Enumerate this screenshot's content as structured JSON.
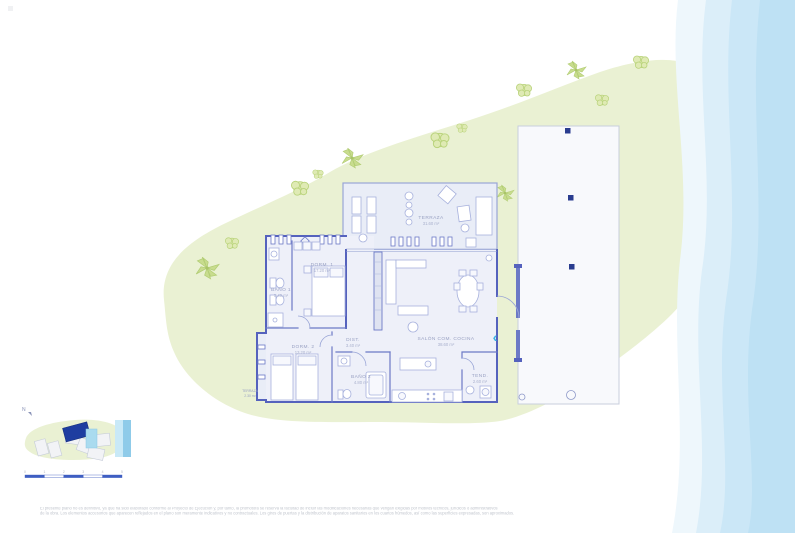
{
  "plan": {
    "rooms": [
      {
        "id": "terraza",
        "label": "TERRAZA",
        "area": "31.60 m²"
      },
      {
        "id": "dorm1",
        "label": "DORM. 1",
        "area": "17.20 m²"
      },
      {
        "id": "bano1",
        "label": "BAÑO 1",
        "area": "5.40 m²"
      },
      {
        "id": "dorm2",
        "label": "DORM. 2",
        "area": "13.20 m²"
      },
      {
        "id": "dist",
        "label": "DIST.",
        "area": "3.40 m²"
      },
      {
        "id": "bano2",
        "label": "BAÑO 2",
        "area": "4.80 m²"
      },
      {
        "id": "salon",
        "label": "SALÓN COM. COCINA",
        "area": "38.60 m²"
      },
      {
        "id": "tend",
        "label": "TEND.",
        "area": "2.60 m²"
      },
      {
        "id": "terraza2",
        "label": "TERRAZA",
        "area": "2.30 m²"
      }
    ],
    "nav_chevron": "‹"
  },
  "minimap": {
    "compass": "N"
  },
  "scalebar": {
    "ticks": [
      "0",
      "1",
      "2",
      "3",
      "4",
      "5"
    ],
    "unit": "m"
  },
  "disclaimer": {
    "line1": "El presente plano no es definitivo, ya que ha sido elaborado conforme al Proyecto de Ejecución y, por tanto, la promotora se reserva la facultad de incluir las modificaciones necesarias que vengan exigidas por motivos técnicos, jurídicos o administrativos",
    "line2": "de la obra. Los elementos accesorios que aparecen reflejados en el plano son meramente indicativos y no contractuales. Los giros de puertas y la distribución de aparatos sanitarios en los cuartos húmedos, así como las superficies expresadas, son aproximados."
  },
  "colors": {
    "accent_cyan": "#3ab4e4",
    "garden_green": "#eaf1d3",
    "tree_green": "#c9dd92",
    "wall_blue": "#5562bd",
    "sea_blue": "#bee1f4",
    "highlight_navy": "#1e3da0",
    "pool_blue": "#aadbef",
    "scalebar_blue": "#3f5ec2"
  }
}
